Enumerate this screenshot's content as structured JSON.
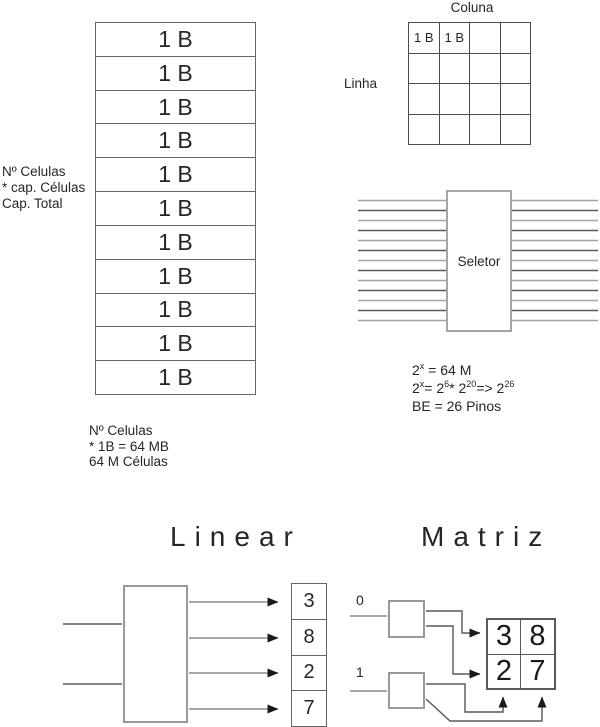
{
  "memory_stack": {
    "cells": [
      "1 B",
      "1 B",
      "1 B",
      "1 B",
      "1 B",
      "1 B",
      "1 B",
      "1 B",
      "1 B",
      "1 B",
      "1 B"
    ],
    "side_note": [
      "Nº Celulas",
      "* cap. Células",
      "Cap. Total"
    ],
    "bottom_note": [
      "Nº Celulas",
      "* 1B = 64 MB",
      "64 M Células"
    ]
  },
  "matrix_memory": {
    "col_label": "Coluna",
    "row_label": "Linha",
    "cells": [
      "1 B",
      "1 B",
      "",
      "",
      "",
      "",
      "",
      "",
      "",
      "",
      "",
      "",
      "",
      "",
      "",
      ""
    ]
  },
  "selector": {
    "label": "Seletor",
    "address_lines_per_side": 13
  },
  "formulas": {
    "f1": {
      "parts": [
        {
          "t": "2"
        },
        {
          "s": "x"
        },
        {
          "t": " = 64 M"
        }
      ]
    },
    "f2": {
      "parts": [
        {
          "t": "2"
        },
        {
          "s": "x"
        },
        {
          "t": "= 2"
        },
        {
          "s": "6"
        },
        {
          "t": "* 2"
        },
        {
          "s": "20"
        },
        {
          "t": "=> 2"
        },
        {
          "s": "26"
        }
      ]
    },
    "f3": {
      "text": "BE = 26 Pinos"
    }
  },
  "linear_section": {
    "title": "Linear",
    "output_cells": [
      "3",
      "8",
      "2",
      "7"
    ]
  },
  "matrix_section": {
    "title": "Matriz",
    "row_select_labels": [
      "0",
      "1"
    ],
    "grid_cells": [
      "3",
      "8",
      "2",
      "7"
    ]
  },
  "colors": {
    "line_light": "#a3a3a3",
    "line_dark": "#595959",
    "arrow_shaft": "#8c8c8c",
    "arrow_head": "#1a1a1a",
    "box_border": "#999999",
    "text": "#262626"
  }
}
